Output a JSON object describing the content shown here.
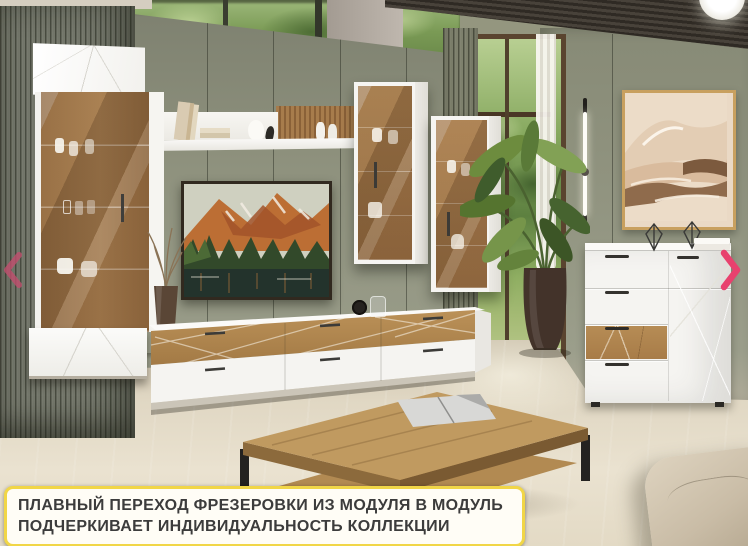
{
  "caption": {
    "line1": "ПЛАВНЫЙ ПЕРЕХОД ФРЕЗЕРОВКИ ИЗ МОДУЛЯ В МОДУЛЬ",
    "line2": "ПОДЧЕРКИВАЕТ ИНДИВИДУАЛЬНОСТЬ КОЛЛЕКЦИИ",
    "background": "#fffdf6",
    "border_color": "#f1d647",
    "text_color": "#3c3c3c"
  },
  "carousel": {
    "prev_icon": "chevron-left",
    "next_icon": "chevron-right",
    "arrow_color": "#e0466f"
  },
  "colors": {
    "wall_green": "#8f927e",
    "slat_panel": "#73766a",
    "furniture_white": "#f6f5f2",
    "oak_wood": "#b28753",
    "floor": "#e2d9c6",
    "ceiling_wood": "#3a342c"
  }
}
